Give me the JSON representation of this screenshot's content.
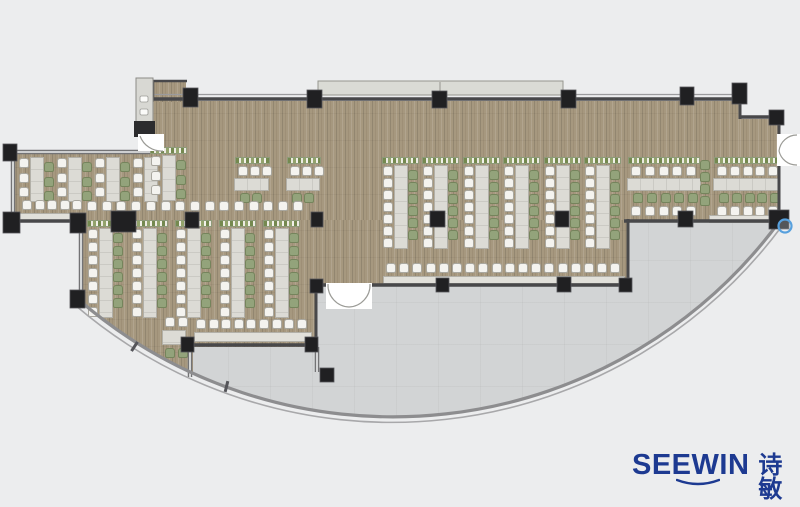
{
  "brand": {
    "wordmark": "SEEWIN",
    "cjk": "诗敏",
    "color": "#1d3a91"
  },
  "plan": {
    "palette": {
      "background": "#ecedee",
      "terrace": "#d2d4d5",
      "wall": "#48484a",
      "wall_light": "#9b9b9d",
      "glass": "#737375",
      "glass_gap": "#edeeee",
      "column": "#202022",
      "column_edge": "#55555a",
      "curve_main": "#8d8d8f",
      "curve_outer": "#a8a8aa",
      "canopy": "#dadbd5",
      "canopy_border": "#96968f",
      "shaft": "#d8d8d3",
      "shaft_border": "#8b8b87",
      "shaft_cap": "#2c2c2e",
      "door_fill": "#ffffff",
      "door_line": "#9b9b96",
      "marker_blue": "#57a0dd"
    },
    "regions": {
      "clip": "M 0 0 H 800 V 226 L 779 222 A 480 480 0 0 1 79 300 L 0 300 Z",
      "floor_rects": [
        [
          153,
          101,
          587,
          121
        ],
        [
          740,
          119,
          39,
          103
        ],
        [
          150,
          82,
          36,
          20
        ],
        [
          13,
          152,
          140,
          70
        ],
        [
          79,
          220,
          549,
          65
        ],
        [
          79,
          285,
          237,
          62
        ],
        [
          79,
          347,
          114,
          33
        ]
      ],
      "terrace_rect": [
        186,
        219,
        596,
        210
      ]
    },
    "curve": {
      "main": "M 79 300 A 480 480 0 0 0 779 222",
      "outer": "M 75 305 A 486 486 0 0 0 782 226",
      "ticks": [
        [
          133,
          341,
          33
        ],
        [
          225,
          381,
          14
        ]
      ]
    },
    "walls": {
      "solid": [
        [
          153,
          99,
          741,
          99,
          3.5
        ],
        [
          740,
          97,
          740,
          119,
          3
        ],
        [
          739,
          117,
          781,
          117,
          3.5
        ],
        [
          779,
          115,
          779,
          223,
          3
        ],
        [
          624,
          221,
          780,
          221,
          3.5
        ],
        [
          628,
          219,
          628,
          287,
          3
        ],
        [
          316,
          285,
          628,
          285,
          3.5
        ],
        [
          316,
          284,
          316,
          348,
          3
        ],
        [
          187,
          345,
          317,
          345,
          3.5
        ],
        [
          150,
          81,
          187,
          81,
          2.5
        ],
        [
          153,
          81,
          153,
          99,
          2.5
        ],
        [
          12,
          221,
          86,
          221,
          3.5
        ]
      ],
      "light": [
        [
          153,
          94.5,
          740,
          94.5
        ]
      ],
      "glass": [
        [
          13,
          152,
          150,
          152
        ],
        [
          13,
          152,
          13,
          221
        ],
        [
          81,
          221,
          81,
          297
        ],
        [
          190,
          346,
          190,
          377
        ],
        [
          317,
          347,
          317,
          372
        ]
      ]
    },
    "columns": [
      [
        183,
        88,
        15,
        19
      ],
      [
        307,
        90,
        15,
        18
      ],
      [
        432,
        91,
        15,
        17
      ],
      [
        561,
        90,
        15,
        18
      ],
      [
        680,
        87,
        14,
        18
      ],
      [
        732,
        83,
        15,
        21
      ],
      [
        769,
        110,
        15,
        15
      ],
      [
        769,
        210,
        20,
        19
      ],
      [
        678,
        211,
        15,
        16
      ],
      [
        619,
        278,
        13,
        14
      ],
      [
        557,
        277,
        14,
        15
      ],
      [
        436,
        278,
        13,
        14
      ],
      [
        310,
        279,
        13,
        14
      ],
      [
        305,
        337,
        13,
        15
      ],
      [
        181,
        337,
        13,
        15
      ],
      [
        320,
        368,
        14,
        14
      ],
      [
        185,
        212,
        14,
        16
      ],
      [
        311,
        212,
        12,
        15
      ],
      [
        430,
        211,
        15,
        16
      ],
      [
        555,
        211,
        14,
        16
      ],
      [
        111,
        211,
        25,
        21
      ],
      [
        3,
        144,
        14,
        17
      ],
      [
        3,
        212,
        17,
        21
      ],
      [
        70,
        213,
        16,
        20
      ],
      [
        70,
        290,
        15,
        18
      ]
    ],
    "canopy": {
      "rect": [
        318,
        81,
        245,
        14
      ],
      "divider_x": 440
    },
    "shaft": {
      "body": [
        136,
        78,
        17,
        47
      ],
      "handles": [
        [
          140,
          96,
          8,
          6
        ],
        [
          140,
          109,
          8,
          6
        ]
      ],
      "cap": [
        134,
        121,
        21,
        16
      ]
    },
    "doors": {
      "right": {
        "rect": [
          777,
          134,
          23,
          32
        ],
        "arcs": [
          "M 797 135 A 18 18 0 0 0 779 151",
          "M 797 165 A 18 18 0 0 1 779 151"
        ]
      },
      "south": {
        "rect": [
          326,
          283,
          46,
          26
        ],
        "arcs": [
          "M 328 284 A 22 22 0 0 0 349 307",
          "M 370 284 A 22 22 0 0 1 349 307"
        ]
      },
      "shaft_door": {
        "rect": [
          138,
          134,
          26,
          17
        ],
        "arcs": [
          "M 140 136 A 23 23 0 0 0 163 151"
        ]
      }
    },
    "marker": {
      "cx": 785,
      "cy": 226,
      "r": 6.5
    },
    "furniture": {
      "vertical_units": [
        {
          "x": 383,
          "y": 166,
          "nw": 7,
          "ng": 6,
          "pitch": 12,
          "dh": 84,
          "planter": true
        },
        {
          "x": 423,
          "y": 166,
          "nw": 7,
          "ng": 6,
          "pitch": 12,
          "dh": 84,
          "planter": true
        },
        {
          "x": 464,
          "y": 166,
          "nw": 7,
          "ng": 6,
          "pitch": 12,
          "dh": 84,
          "planter": true
        },
        {
          "x": 504,
          "y": 166,
          "nw": 7,
          "ng": 6,
          "pitch": 12,
          "dh": 84,
          "planter": true
        },
        {
          "x": 545,
          "y": 166,
          "nw": 7,
          "ng": 6,
          "pitch": 12,
          "dh": 84,
          "planter": true
        },
        {
          "x": 585,
          "y": 166,
          "nw": 7,
          "ng": 6,
          "pitch": 12,
          "dh": 84,
          "planter": true
        },
        {
          "x": 88,
          "y": 229,
          "nw": 7,
          "ng": 6,
          "pitch": 13,
          "dh": 90,
          "planter": true
        },
        {
          "x": 132,
          "y": 229,
          "nw": 7,
          "ng": 6,
          "pitch": 13,
          "dh": 90,
          "planter": true
        },
        {
          "x": 176,
          "y": 229,
          "nw": 7,
          "ng": 6,
          "pitch": 13,
          "dh": 90,
          "planter": true
        },
        {
          "x": 220,
          "y": 229,
          "nw": 7,
          "ng": 6,
          "pitch": 13,
          "dh": 90,
          "planter": true
        },
        {
          "x": 264,
          "y": 229,
          "nw": 7,
          "ng": 6,
          "pitch": 13,
          "dh": 90,
          "planter": true
        },
        {
          "x": 19,
          "y": 158,
          "nw": 3,
          "ng": 3,
          "pitch": 14.5,
          "dh": 45,
          "planter": false
        },
        {
          "x": 57,
          "y": 158,
          "nw": 3,
          "ng": 3,
          "pitch": 14.5,
          "dh": 45,
          "planter": false
        },
        {
          "x": 95,
          "y": 158,
          "nw": 3,
          "ng": 3,
          "pitch": 14.5,
          "dh": 45,
          "planter": false
        },
        {
          "x": 133,
          "y": 158,
          "nw": 3,
          "ng": 0,
          "pitch": 14.5,
          "dh": 45,
          "planter": false
        },
        {
          "x": 151,
          "y": 156,
          "nw": 3,
          "ng": 3,
          "pitch": 14.5,
          "dh": 46,
          "planter": true
        }
      ],
      "horiz_units": [
        {
          "x": 235,
          "n": 3,
          "pitch": 12,
          "desk_w": 35,
          "green_n": 2,
          "white2": false,
          "planter_w": 35
        },
        {
          "x": 287,
          "n": 3,
          "pitch": 12,
          "desk_w": 34,
          "green_n": 2,
          "white2": false,
          "planter_w": 34
        },
        {
          "x": 628,
          "n": 5,
          "pitch": 13.8,
          "desk_w": 74,
          "green_n": 5,
          "white2": true,
          "planter_w": 72
        },
        {
          "x": 714,
          "n": 5,
          "pitch": 12.8,
          "desk_w": 67,
          "green_n": 5,
          "white2": true,
          "planter_w": 64
        }
      ],
      "horiz_ys": {
        "planter": 157,
        "white": 166,
        "desk": 178,
        "desk_h": 13,
        "green": 193,
        "white2": 206
      },
      "chair_rows": [
        {
          "x": 386,
          "y": 263,
          "n": 18,
          "pitch": 13.2,
          "color": "white"
        },
        {
          "x": 196,
          "y": 319,
          "n": 9,
          "pitch": 12.6,
          "color": "white"
        },
        {
          "x": 22,
          "y": 200,
          "n": 5,
          "pitch": 12.6,
          "color": "white"
        },
        {
          "x": 87,
          "y": 201,
          "n": 15,
          "pitch": 14.7,
          "color": "white"
        },
        {
          "x": 700,
          "y": 160,
          "n": 4,
          "pitch": 12,
          "color": "green",
          "vertical": true
        },
        {
          "x": 165,
          "y": 317,
          "n": 2,
          "pitch": 13,
          "color": "white"
        },
        {
          "x": 165,
          "y": 348,
          "n": 2,
          "pitch": 13,
          "color": "green"
        }
      ],
      "counters": [
        [
          383,
          276,
          242,
          8
        ],
        [
          194,
          332,
          118,
          10
        ],
        [
          18,
          213,
          66,
          9
        ],
        [
          709,
          215,
          72,
          8
        ]
      ],
      "small_table": [
        162,
        330,
        24,
        15
      ]
    }
  }
}
